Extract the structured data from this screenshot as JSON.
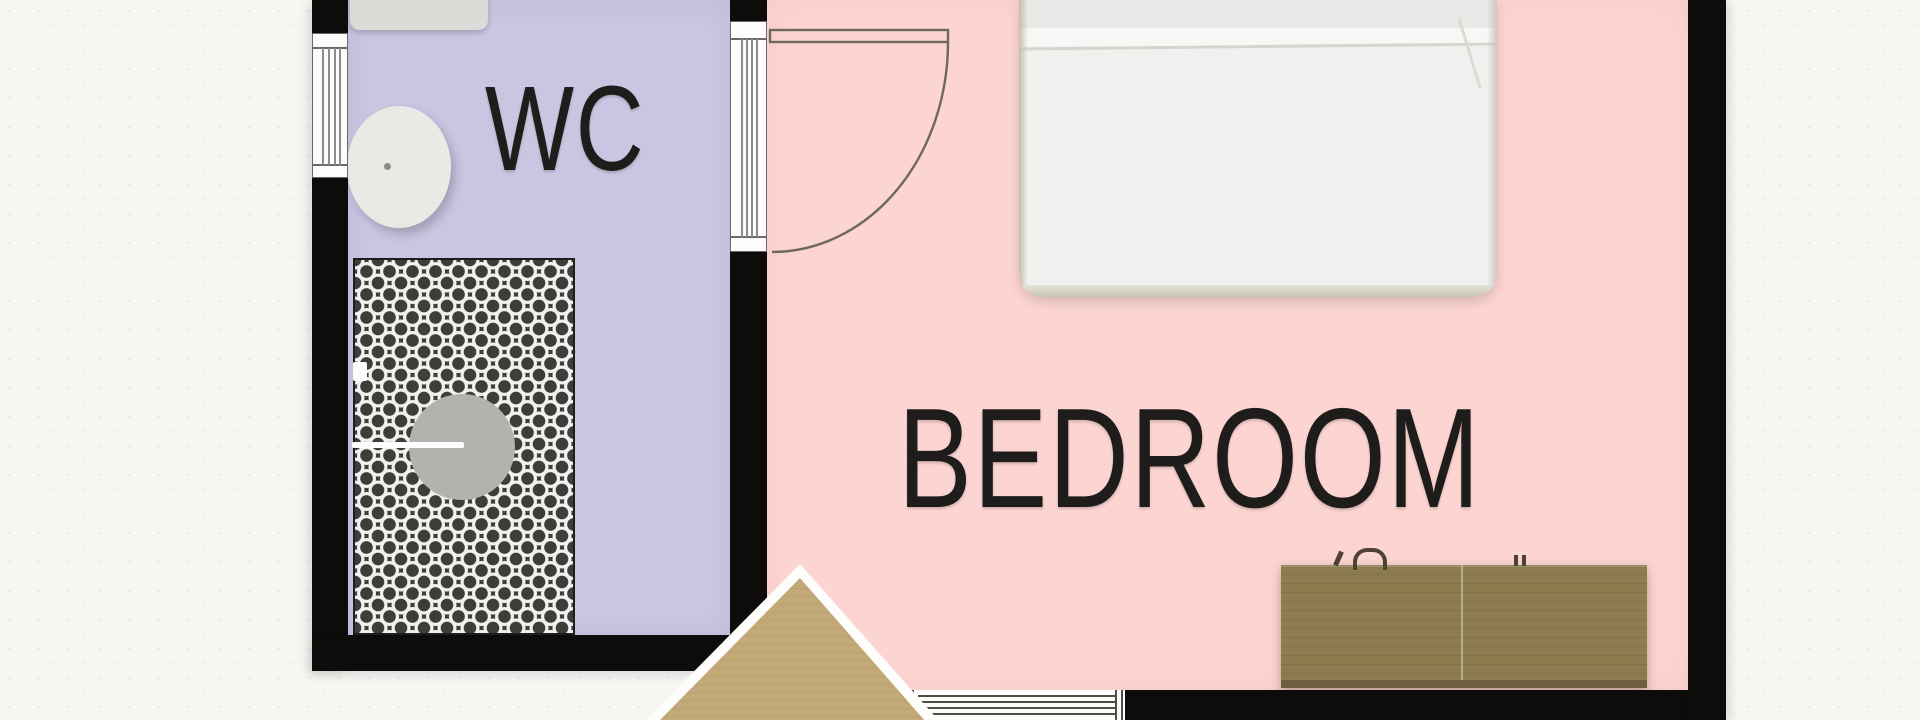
{
  "rooms": {
    "wc": {
      "label": "WC"
    },
    "bedroom": {
      "label": "BEDROOM"
    }
  },
  "colors": {
    "background": "#f7f6f3",
    "wall": "#0d0c0b",
    "wc-floor": "#cac5e1",
    "bedroom-floor": "#fcd4d1",
    "bed": "#f0f0ee",
    "tile-dark": "#3f3d3a",
    "tile-light": "#f2f1ed",
    "dresser-wood": "#8d7c50",
    "triangle-wood": "#c2a977",
    "fixture": "#dcdbd8",
    "sink": "#eae9e6",
    "shower-metal": "#b4b2ae",
    "door-line": "#6e6862",
    "glazing-line": "#8d8a94",
    "label-text": "#1e1d1b"
  }
}
